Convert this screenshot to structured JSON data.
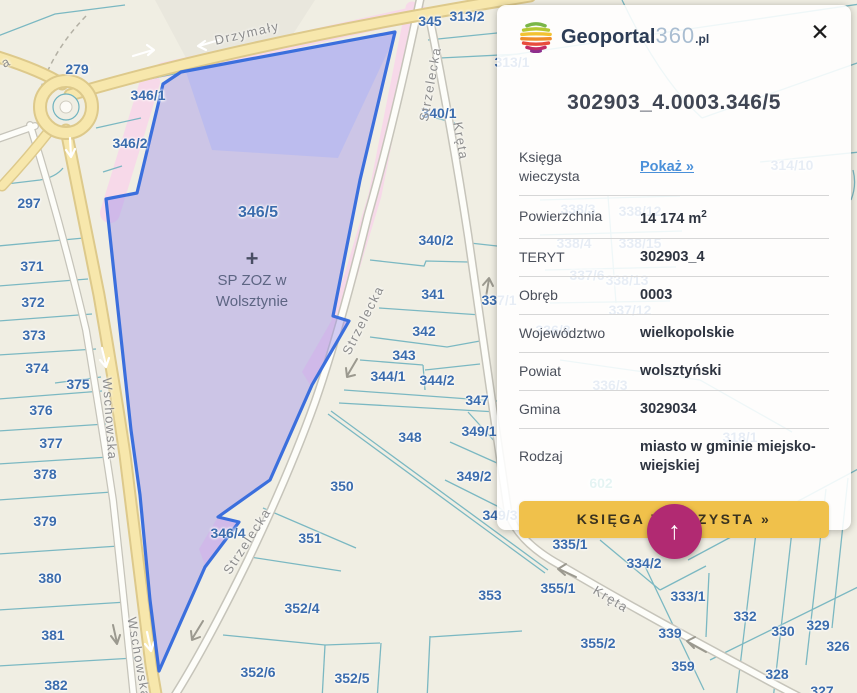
{
  "brand": {
    "name_bold": "Geoportal",
    "name_num": "360",
    "name_tld": ".pl"
  },
  "panel": {
    "title": "302903_4.0003.346/5",
    "rows": [
      {
        "label": "Księga wieczysta",
        "link": "Pokaż »"
      },
      {
        "label": "Powierzchnia",
        "value": "14 174 m",
        "sup": "2"
      },
      {
        "label": "TERYT",
        "value": "302903_4"
      },
      {
        "label": "Obręb",
        "value": "0003"
      },
      {
        "label": "Województwo",
        "value": "wielkopolskie"
      },
      {
        "label": "Powiat",
        "value": "wolsztyński"
      },
      {
        "label": "Gmina",
        "value": "3029034"
      },
      {
        "label": "Rodzaj",
        "value": "miasto w gminie miejsko-wiejskiej"
      }
    ],
    "cta": "KSIĘGA WIECZYSTA »",
    "icons": {
      "close": "✕",
      "scroll_up": "↑"
    }
  },
  "map": {
    "selected_parcel_id": "346/5",
    "poi": {
      "symbol": "+",
      "icon": "hospital-cross",
      "name_line1": "SP ZOZ w",
      "name_line2": "Wolsztynie"
    },
    "colors": {
      "selection_stroke": "#3b6fdd",
      "selection_fill": "#a093e8",
      "pink_zone": "#f7d9e9",
      "road_yellow": "#f7e7ac",
      "label_blue": "#3b6cad",
      "street_gray": "#8d8d8d",
      "accent_magenta": "#b12a72",
      "cta_yellow": "#f0c14b",
      "link_blue": "#4a90d9"
    },
    "parcel_labels": [
      {
        "t": "279",
        "x": 77,
        "y": 69
      },
      {
        "t": "297",
        "x": 29,
        "y": 203
      },
      {
        "t": "346/1",
        "x": 148,
        "y": 95
      },
      {
        "t": "346/2",
        "x": 130,
        "y": 143
      },
      {
        "t": "346/5",
        "x": 258,
        "y": 213,
        "big": true
      },
      {
        "t": "371",
        "x": 32,
        "y": 266
      },
      {
        "t": "372",
        "x": 33,
        "y": 302
      },
      {
        "t": "373",
        "x": 34,
        "y": 335
      },
      {
        "t": "374",
        "x": 37,
        "y": 368
      },
      {
        "t": "375",
        "x": 78,
        "y": 384
      },
      {
        "t": "376",
        "x": 41,
        "y": 410
      },
      {
        "t": "377",
        "x": 51,
        "y": 443
      },
      {
        "t": "378",
        "x": 45,
        "y": 474
      },
      {
        "t": "379",
        "x": 45,
        "y": 521
      },
      {
        "t": "380",
        "x": 50,
        "y": 578
      },
      {
        "t": "381",
        "x": 53,
        "y": 635
      },
      {
        "t": "382",
        "x": 56,
        "y": 685
      },
      {
        "t": "345",
        "x": 430,
        "y": 21
      },
      {
        "t": "313/2",
        "x": 467,
        "y": 16
      },
      {
        "t": "340/1",
        "x": 439,
        "y": 113
      },
      {
        "t": "340/2",
        "x": 436,
        "y": 240
      },
      {
        "t": "341",
        "x": 433,
        "y": 294
      },
      {
        "t": "342",
        "x": 424,
        "y": 331
      },
      {
        "t": "343",
        "x": 404,
        "y": 355
      },
      {
        "t": "344/1",
        "x": 388,
        "y": 376
      },
      {
        "t": "344/2",
        "x": 437,
        "y": 380
      },
      {
        "t": "347",
        "x": 477,
        "y": 400
      },
      {
        "t": "348",
        "x": 410,
        "y": 437
      },
      {
        "t": "349/1",
        "x": 479,
        "y": 431
      },
      {
        "t": "349/2",
        "x": 474,
        "y": 476
      },
      {
        "t": "350",
        "x": 342,
        "y": 486
      },
      {
        "t": "351",
        "x": 310,
        "y": 538
      },
      {
        "t": "352/4",
        "x": 302,
        "y": 608
      },
      {
        "t": "352/5",
        "x": 352,
        "y": 678
      },
      {
        "t": "352/6",
        "x": 258,
        "y": 672
      },
      {
        "t": "353",
        "x": 490,
        "y": 595
      },
      {
        "t": "346/4",
        "x": 228,
        "y": 533
      },
      {
        "t": "335/1",
        "x": 570,
        "y": 544
      },
      {
        "t": "355/1",
        "x": 558,
        "y": 588
      },
      {
        "t": "355/2",
        "x": 598,
        "y": 643
      },
      {
        "t": "334/2",
        "x": 644,
        "y": 563
      },
      {
        "t": "333/1",
        "x": 688,
        "y": 596
      },
      {
        "t": "339",
        "x": 670,
        "y": 633
      },
      {
        "t": "359",
        "x": 683,
        "y": 666
      },
      {
        "t": "332",
        "x": 745,
        "y": 616
      },
      {
        "t": "330",
        "x": 783,
        "y": 631
      },
      {
        "t": "329",
        "x": 818,
        "y": 625
      },
      {
        "t": "326",
        "x": 838,
        "y": 646
      },
      {
        "t": "328",
        "x": 777,
        "y": 674
      },
      {
        "t": "327",
        "x": 822,
        "y": 691
      },
      {
        "t": "313/1",
        "x": 512,
        "y": 62
      },
      {
        "t": "314/10",
        "x": 792,
        "y": 165
      },
      {
        "t": "338/3",
        "x": 578,
        "y": 209
      },
      {
        "t": "338/12",
        "x": 640,
        "y": 211
      },
      {
        "t": "338/4",
        "x": 574,
        "y": 243
      },
      {
        "t": "338/15",
        "x": 640,
        "y": 243
      },
      {
        "t": "337/6",
        "x": 587,
        "y": 275
      },
      {
        "t": "338/13",
        "x": 627,
        "y": 280
      },
      {
        "t": "337/12",
        "x": 630,
        "y": 310
      },
      {
        "t": "336/8",
        "x": 553,
        "y": 330
      },
      {
        "t": "336/3",
        "x": 610,
        "y": 385
      },
      {
        "t": "318/1",
        "x": 740,
        "y": 437
      },
      {
        "t": "333/2",
        "x": 736,
        "y": 519
      },
      {
        "t": "349/3",
        "x": 500,
        "y": 515
      },
      {
        "t": "337/1",
        "x": 499,
        "y": 300
      },
      {
        "t": "602",
        "x": 601,
        "y": 483,
        "c": "#2aa198"
      }
    ],
    "street_labels": [
      {
        "t": "Drzymały",
        "x": 247,
        "y": 33,
        "a": -13
      },
      {
        "t": "Wschowska",
        "x": 110,
        "y": 419,
        "a": 86
      },
      {
        "t": "Wschowska",
        "x": 139,
        "y": 658,
        "a": 80
      },
      {
        "t": "Strzelecka",
        "x": 430,
        "y": 84,
        "a": -80
      },
      {
        "t": "Strzelecka",
        "x": 363,
        "y": 320,
        "a": -63
      },
      {
        "t": "Strzelecka",
        "x": 247,
        "y": 541,
        "a": -57
      },
      {
        "t": "Kręta",
        "x": 461,
        "y": 141,
        "a": 80
      },
      {
        "t": "Kręta",
        "x": 611,
        "y": 599,
        "a": 31
      },
      {
        "t": "a",
        "x": 6,
        "y": 62,
        "a": -25
      }
    ]
  }
}
